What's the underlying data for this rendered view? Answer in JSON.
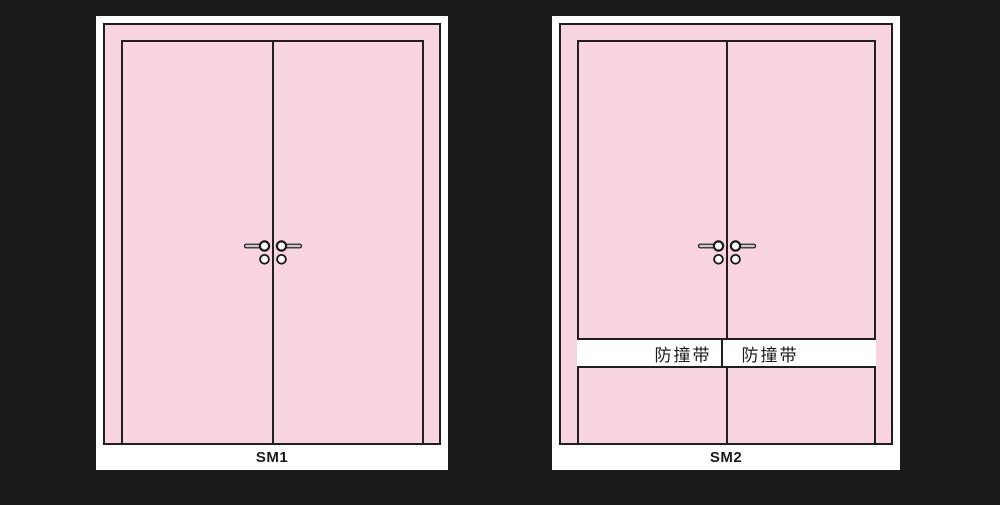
{
  "colors": {
    "background": "#1a1a1a",
    "panel_background": "#ffffff",
    "door_fill": "#f8d3e2",
    "outline": "#221e1f",
    "lever_fill": "#c9c9c9",
    "strip_background": "#ffffff",
    "text": "#1a1a1a"
  },
  "panels": [
    {
      "label": "SM1",
      "strip": null
    },
    {
      "label": "SM2",
      "strip": {
        "left_label": "防撞带",
        "right_label": "防撞带"
      }
    }
  ]
}
